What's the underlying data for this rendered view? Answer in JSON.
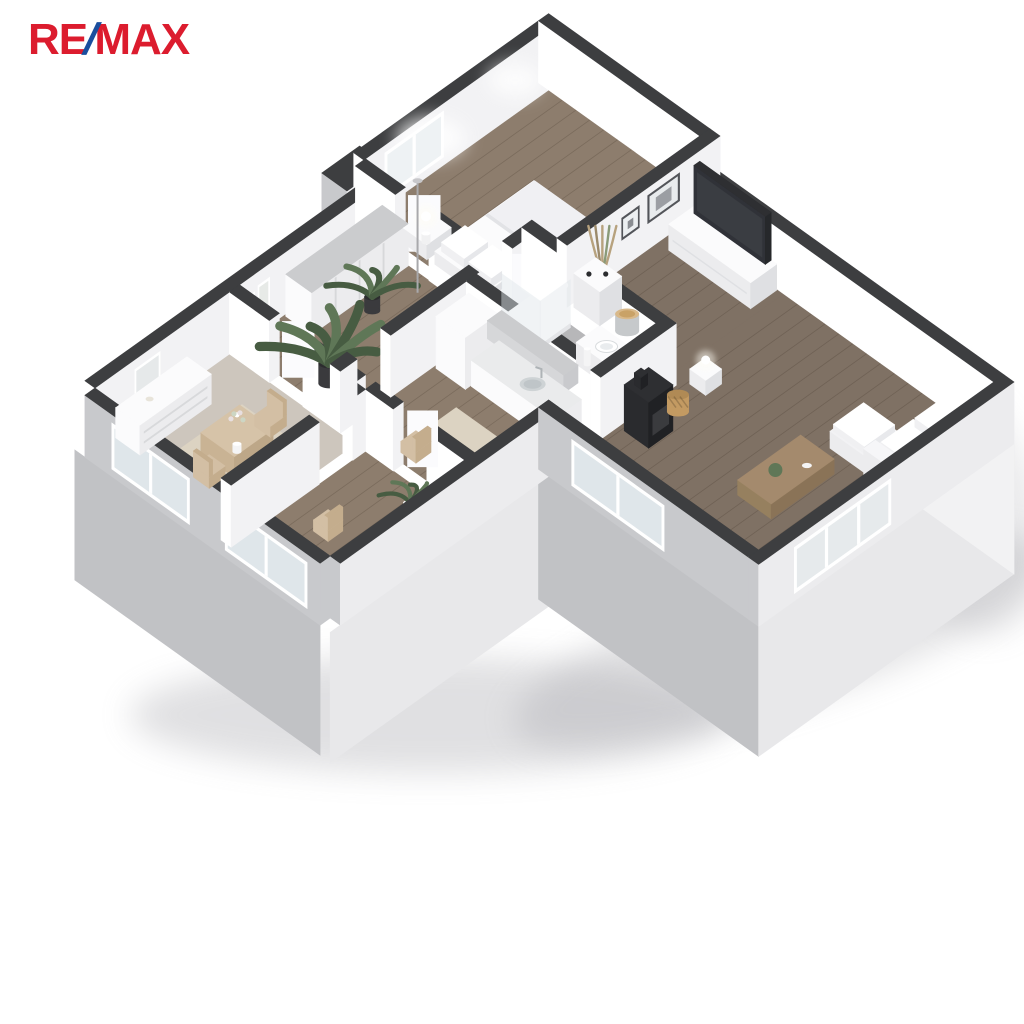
{
  "logo": {
    "re": "RE",
    "slash": "/",
    "max": "MAX",
    "red": "#dc1c2e",
    "blue": "#1a4e9e"
  },
  "page": {
    "background": "#ffffff"
  },
  "palette": {
    "wallTop": "#3d3e40",
    "wallFaceWest": "#ffffff",
    "wallFaceSouth": "#f2f2f4",
    "extWest": "#c8c9cc",
    "extSouth": "#ececee",
    "extEast": "#f2f2f3",
    "plinthWest": "#c1c2c5",
    "plinthSouth": "#e8e8ea",
    "floorWood": "#8d7d6d",
    "floorWoodDark": "#80726395",
    "floorWoodLiving": "#7f7164",
    "plank": "rgba(40,28,16,0.18)",
    "floorLaminate": "#cdc6bd",
    "floorTile": "#b7b7b9",
    "tileLine": "rgba(255,255,255,0.30)",
    "rug": "#dcd3c2",
    "furnTop": "#fbfbfc",
    "furnWest": "#ececee",
    "furnSouth": "#dfe0e3",
    "grayTop": "#cbccce",
    "grayFace": "#d6d7d9",
    "woodFurn": "#d6c3a8",
    "woodFurnDark": "#a48a6d",
    "black": "#202124",
    "blackTop": "#2e2f32",
    "glass": "#dfe6ea",
    "glassBright": "#eef2f4",
    "frameWhite": "#ffffff",
    "green": "#5f7757",
    "greenDark": "#475c42",
    "tan": "#d3bfa4",
    "tanDark": "#c4ad8d",
    "basket": "#c39a62",
    "potDark": "#3a3a3d",
    "glow": "#fffdf4",
    "shadow": "#9a9aa0"
  },
  "scene": {
    "title": "3D apartment floor plan",
    "rooms": [
      {
        "id": "bedroom",
        "label": "Bedroom",
        "floor": "wood",
        "items": [
          "bed",
          "pillows",
          "nightstand-left",
          "nightstand-right",
          "table-lamp-left",
          "table-lamp-right",
          "window"
        ]
      },
      {
        "id": "hall",
        "label": "Hallway",
        "floor": "wood",
        "items": [
          "wardrobe",
          "large-plant",
          "small-plant",
          "floor-lamp",
          "wall-art"
        ]
      },
      {
        "id": "dining",
        "label": "Dining room",
        "floor": "laminate",
        "items": [
          "dresser",
          "mirror",
          "dining-table",
          "flower-vase",
          "chair-east",
          "chair-west",
          "rug"
        ]
      },
      {
        "id": "study",
        "label": "Study",
        "floor": "wood",
        "items": [
          "chair",
          "plant"
        ]
      },
      {
        "id": "kitchen",
        "label": "Kitchen",
        "floor": "wood",
        "items": [
          "tall-cabinet",
          "upper-cabinets",
          "counter",
          "sink",
          "rug",
          "chair"
        ]
      },
      {
        "id": "bathroom",
        "label": "Bathroom",
        "floor": "tile",
        "items": [
          "shower",
          "vanity",
          "basin",
          "sparkle-decor"
        ]
      },
      {
        "id": "living",
        "label": "Living room",
        "floor": "wood-dark",
        "items": [
          "tv-console",
          "tv",
          "wall-frames",
          "dry-plant",
          "knob-cabinet",
          "round-table",
          "stove",
          "basket",
          "side-table",
          "coffee-table",
          "sofa"
        ]
      }
    ]
  }
}
